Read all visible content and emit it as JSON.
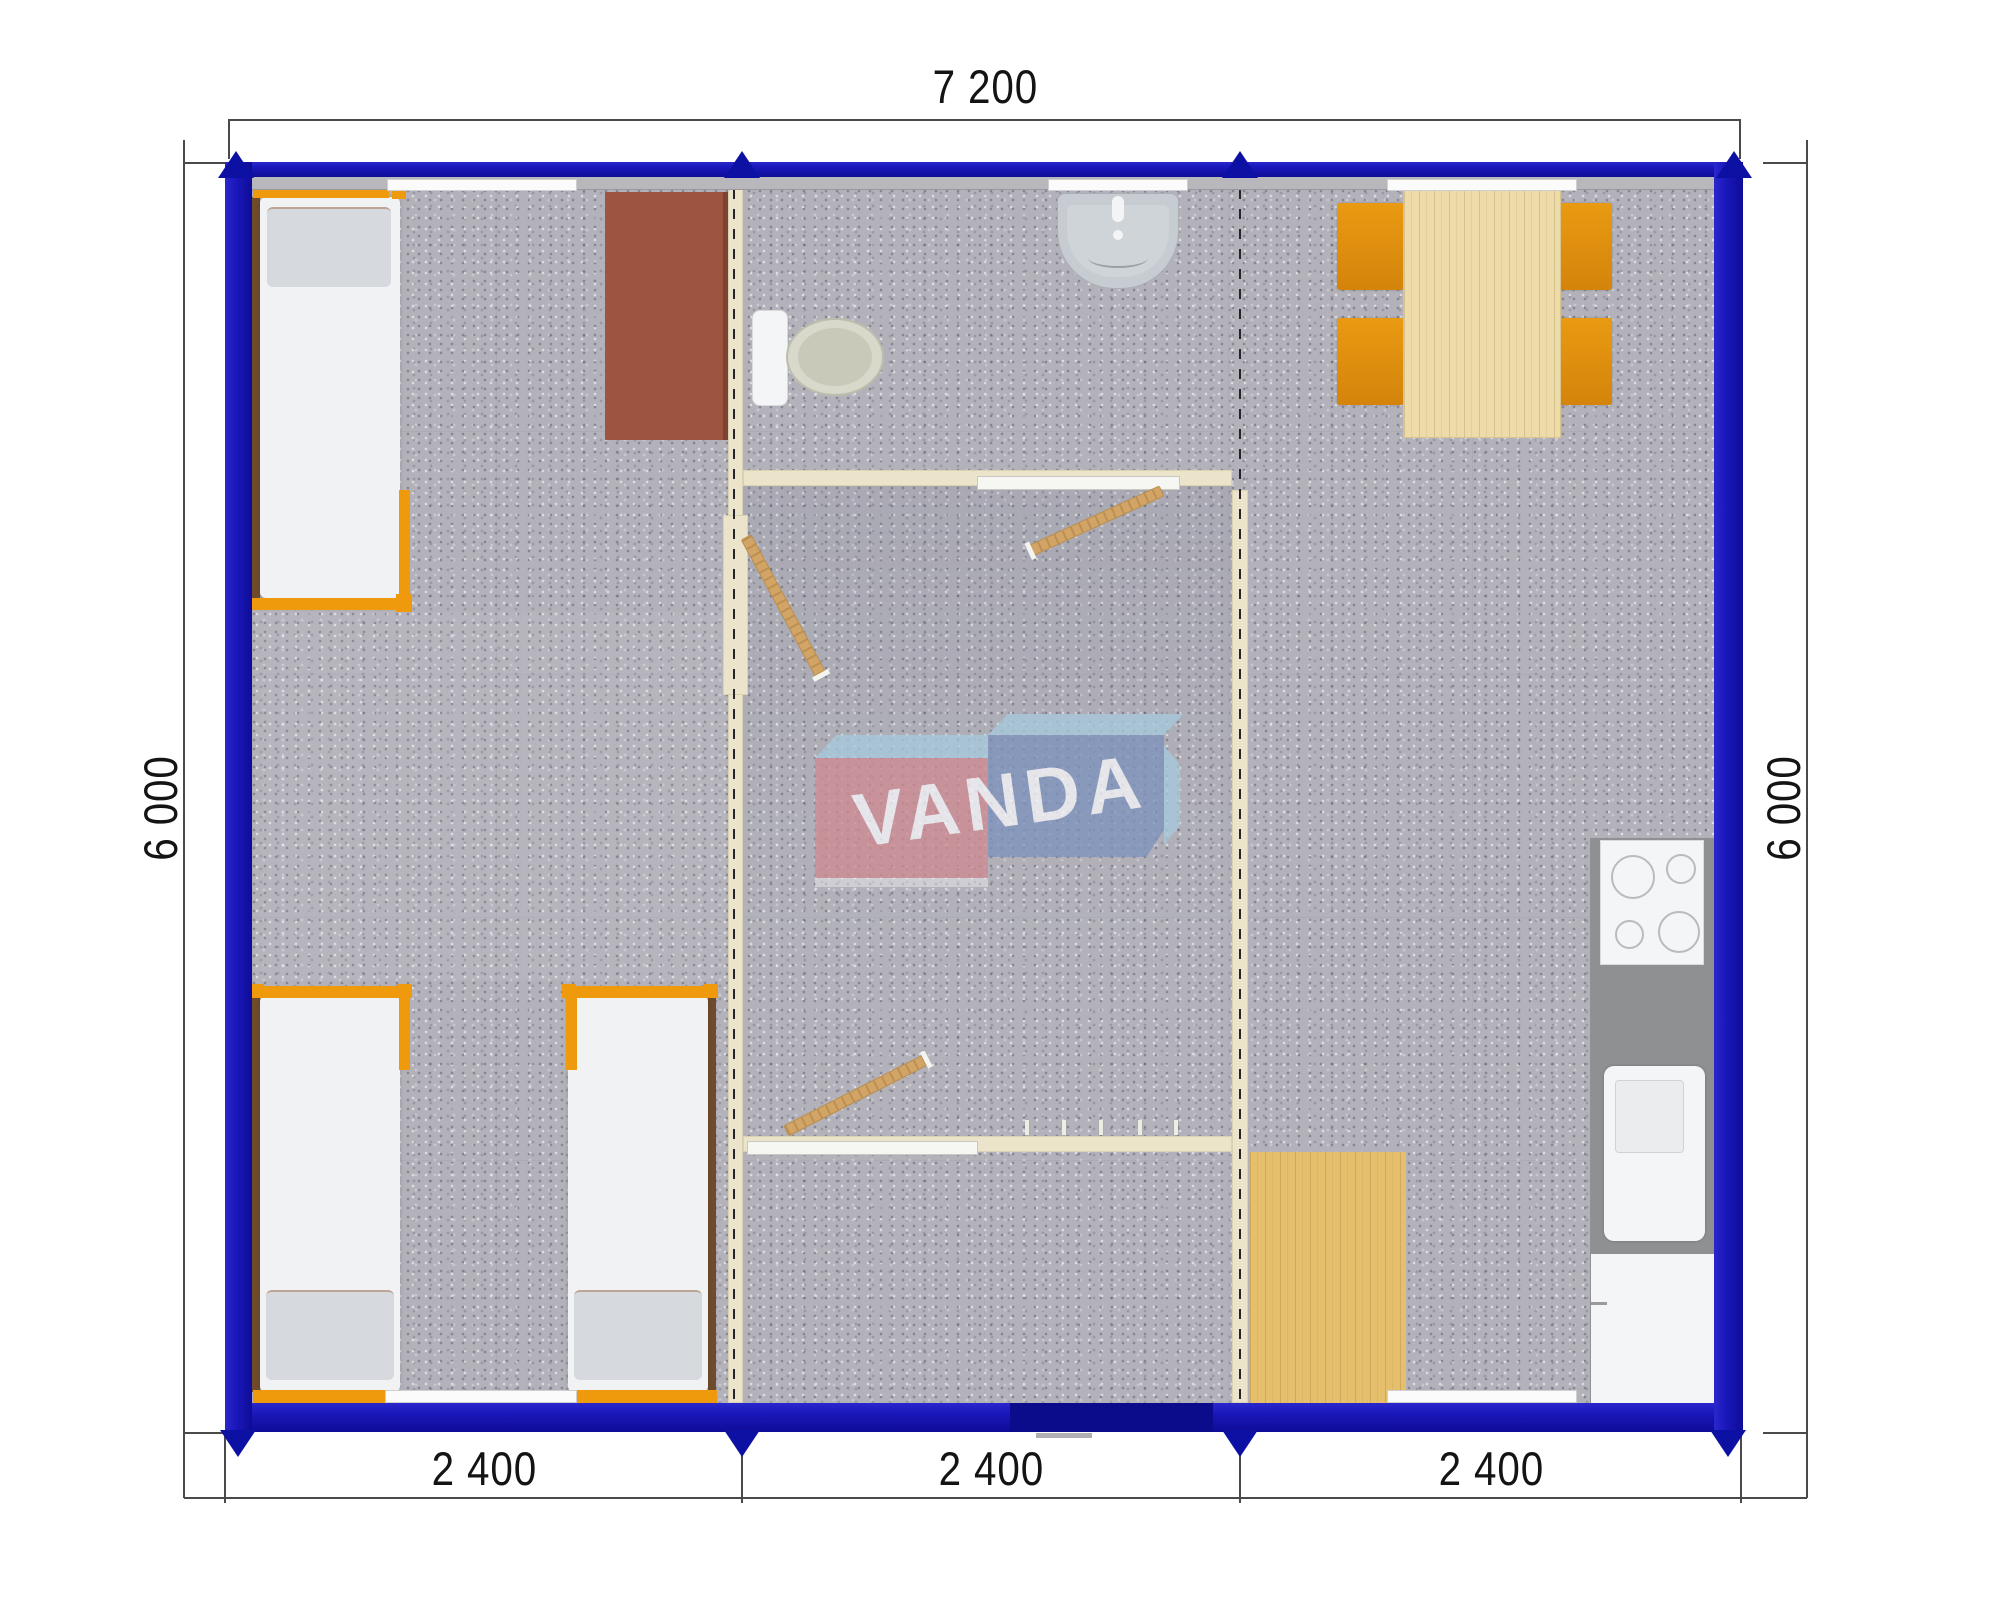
{
  "dimensions": {
    "top": "7 200",
    "left": "6 000",
    "right": "6 000",
    "bottom": [
      "2 400",
      "2 400",
      "2 400"
    ]
  },
  "watermark": {
    "text": "VANDA",
    "box_left_color": "#cf8a92",
    "box_right_color": "#7e93bd",
    "bevel_color": "#a7c9dd",
    "text_color": "#f5f5f9"
  },
  "palette": {
    "exterior_wall_blue": "#1a18bb",
    "partition_cream": "#ebe4ca",
    "carpet_gray": "#b3b2ba",
    "bed_frame_orange": "#ef9a0c",
    "chair_orange": "#e18e04",
    "desk_brown": "#9e5540",
    "dining_table_wood": "#eddcaa",
    "deck_wood": "#e6bf6d",
    "door_wood": "#d2a466",
    "kitchen_counter_gray": "#8f9092",
    "fixture_white": "#f4f5f6",
    "dimension_text": "#141414"
  },
  "objects": [
    "single-bed",
    "desk",
    "toilet",
    "washbasin",
    "swing-door",
    "dining-table",
    "chair",
    "cooktop",
    "kitchen-sink",
    "kitchen-cabinet",
    "wood-deck",
    "coat-hooks",
    "entrance-door",
    "window-sill",
    "module-junction"
  ]
}
